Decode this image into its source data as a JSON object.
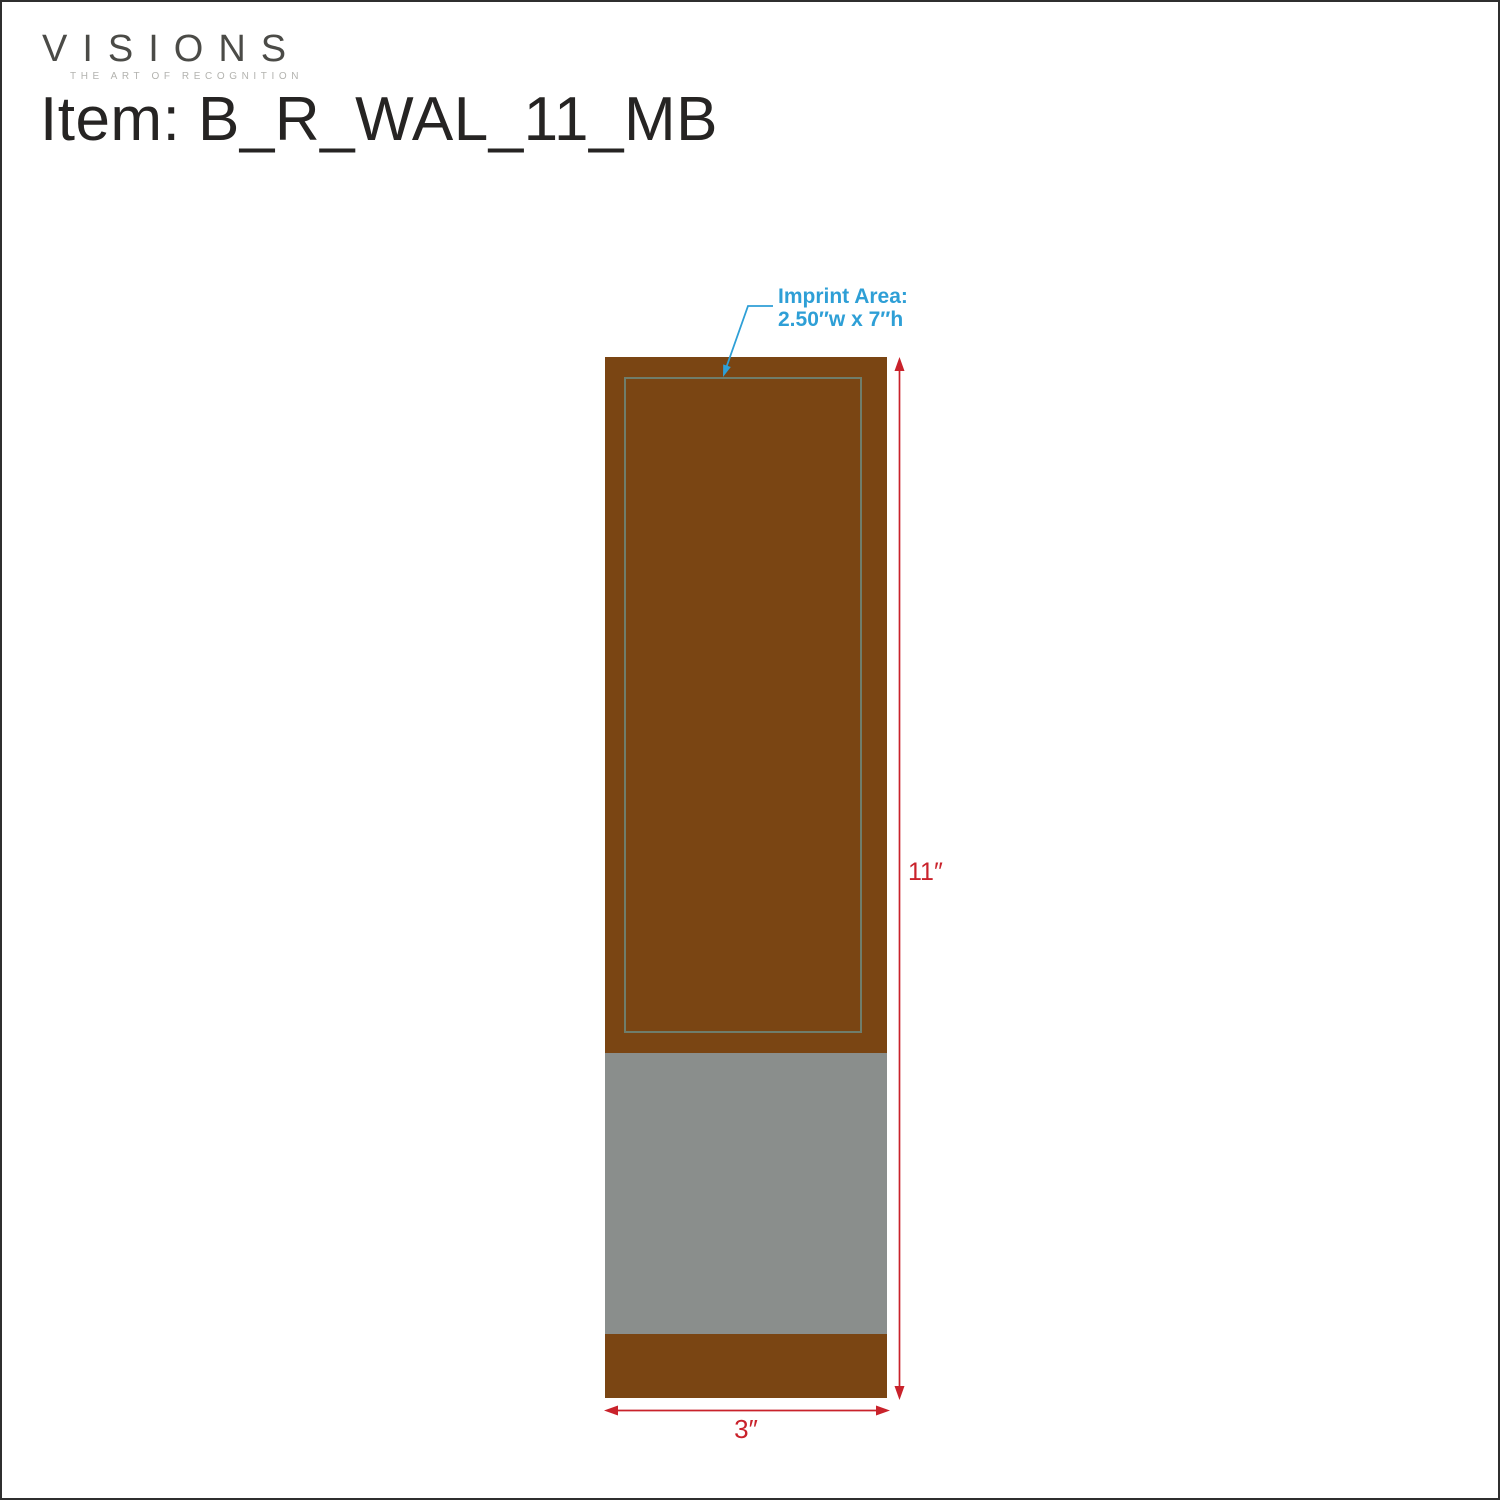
{
  "header": {
    "logo_text": "VISIONS",
    "logo_tagline": "THE ART OF RECOGNITION",
    "item_prefix": "Item:",
    "item_code": "B_R_WAL_11_MB"
  },
  "diagram": {
    "imprint_annotation": {
      "label": "Imprint Area:",
      "size": "2.50″w x 7″h"
    },
    "dimensions": {
      "height": "11″",
      "width": "3″"
    }
  },
  "colors": {
    "plaque_brown": "#7A4513",
    "band_gray": "#8A8E8C",
    "imprint_border": "#6F7D6B",
    "dimension_red": "#C9222B",
    "annotation_blue": "#2E9FD6",
    "logo_gray": "#4B4B47",
    "tagline_gray": "#B3B3AF",
    "title_color": "#262423",
    "page_border": "#2F2F2F"
  }
}
